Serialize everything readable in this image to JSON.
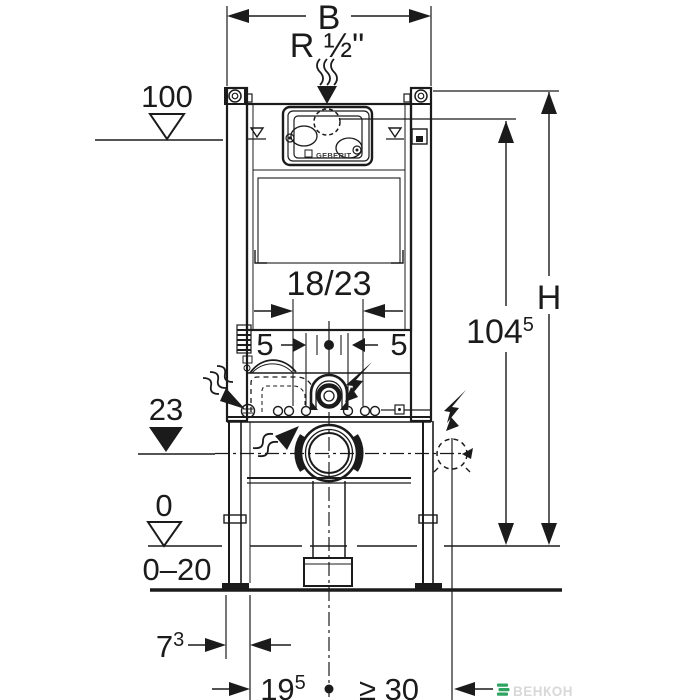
{
  "labels": {
    "width_b": "B",
    "water_supply": "R ½\"",
    "height_100": "100",
    "cistern_size": "18/23",
    "offset_left": "5",
    "offset_right": "5",
    "outlet_level": "23",
    "total_height": "H",
    "supply_height": {
      "base": "104",
      "sup": "5"
    },
    "floor_zero": "0",
    "floor_range": "0–20",
    "frame_depth": {
      "base": "7",
      "sup": "3"
    },
    "outlet_distance": {
      "base": "19",
      "sup": "5"
    },
    "min_clearance": "≥ 30",
    "brand": "GEBERIT",
    "watermark": "ВЕНКОН"
  },
  "colors": {
    "line": "#1b1b1b",
    "background": "#ffffff",
    "watermark_icon": "#2fa360",
    "watermark_text": "#d8d8d8"
  }
}
